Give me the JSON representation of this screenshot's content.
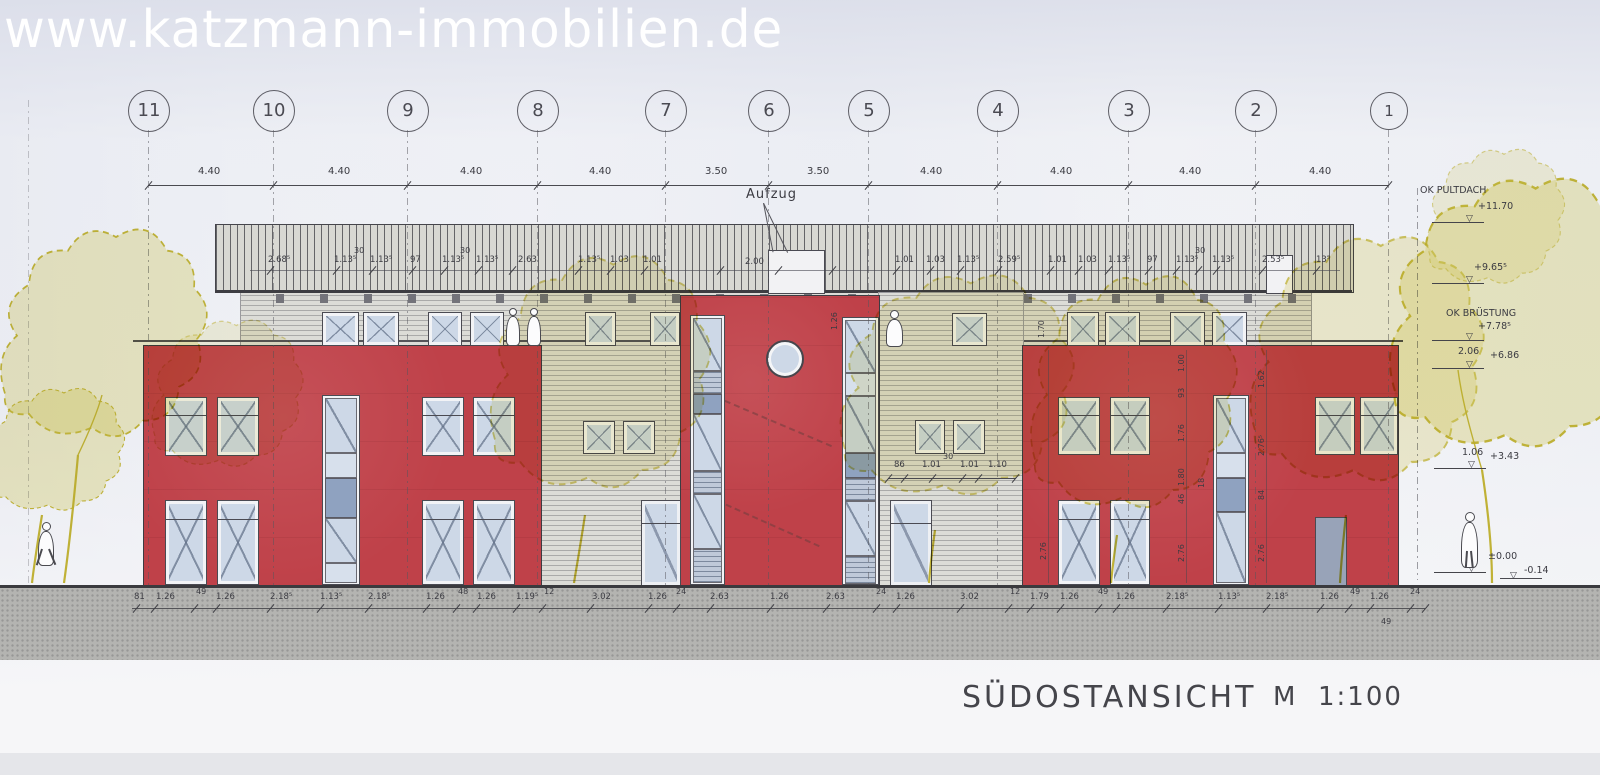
{
  "watermark": "www.katzmann-immobilien.de",
  "title": {
    "view": "SÜDOSTANSICHT",
    "scale_prefix": "M",
    "scale": "1:100"
  },
  "grid_axes": [
    "11",
    "10",
    "9",
    "8",
    "7",
    "6",
    "5",
    "4",
    "3",
    "2",
    "1"
  ],
  "labels": {
    "elevator": "Aufzug"
  },
  "dims": {
    "top": [
      "4.40",
      "4.40",
      "4.40",
      "4.40",
      "3.50",
      "3.50",
      "4.40",
      "4.40",
      "4.40",
      "4.40"
    ],
    "roof": [
      "2.68⁵",
      "1.13⁵",
      "30",
      "1.13⁵",
      "97",
      "1.13⁵",
      "30",
      "1.13⁵",
      "2.63",
      "1.13⁵",
      "1.03",
      "1.01",
      "2.00",
      "1.01",
      "1.03",
      "1.13⁵",
      "2.59⁵",
      "1.01",
      "1.03",
      "1.13⁵",
      "97",
      "1.13⁵",
      "30",
      "1.13⁵",
      "2.53⁵",
      "13⁵"
    ],
    "mid": [
      "86",
      "1.01",
      "30",
      "1.01",
      "1.10"
    ],
    "bottom": [
      "81",
      "1.26",
      "49",
      "1.26",
      "2.18⁵",
      "1.13⁵",
      "2.18⁵",
      "1.26",
      "48",
      "1.26",
      "1.19⁵",
      "12",
      "3.02",
      "1.26",
      "24",
      "2.63",
      "1.26",
      "2.63",
      "24",
      "1.26",
      "3.02",
      "12",
      "1.79",
      "1.26",
      "49",
      "1.26",
      "2.18⁵",
      "1.13⁵",
      "2.18⁵",
      "1.26",
      "49",
      "1.26",
      "24"
    ],
    "bottom_extra": "49",
    "side": [
      "2.76",
      "1.70",
      "1.26",
      "1.00",
      "93",
      "1.76",
      "1.80",
      "46",
      "18",
      "2.76",
      "1.62",
      "2.76⁵",
      "84",
      "2.76"
    ]
  },
  "levels": [
    {
      "label": "OK PULTDACH",
      "value": "+11.70"
    },
    {
      "label": "",
      "value": "+9.65⁵"
    },
    {
      "label": "OK BRÜSTUNG",
      "value": "+7.78⁵"
    },
    {
      "label": "2.06",
      "value": "+6.86"
    },
    {
      "label": "1.06",
      "value": "+3.43"
    },
    {
      "label": "EG",
      "value": "±0.00"
    },
    {
      "label": "",
      "value": "-0.14"
    }
  ],
  "colors": {
    "paper": "#eef0f5",
    "facade_red": "#bf4149",
    "glass_blue": "#cdd8e7",
    "siding_gray": "#dcdcd7",
    "roof_gray": "#d8d8d3",
    "ground_gray": "#b4b4b1",
    "highlight_yellow": "#d8c84a",
    "ink": "#44444a"
  }
}
